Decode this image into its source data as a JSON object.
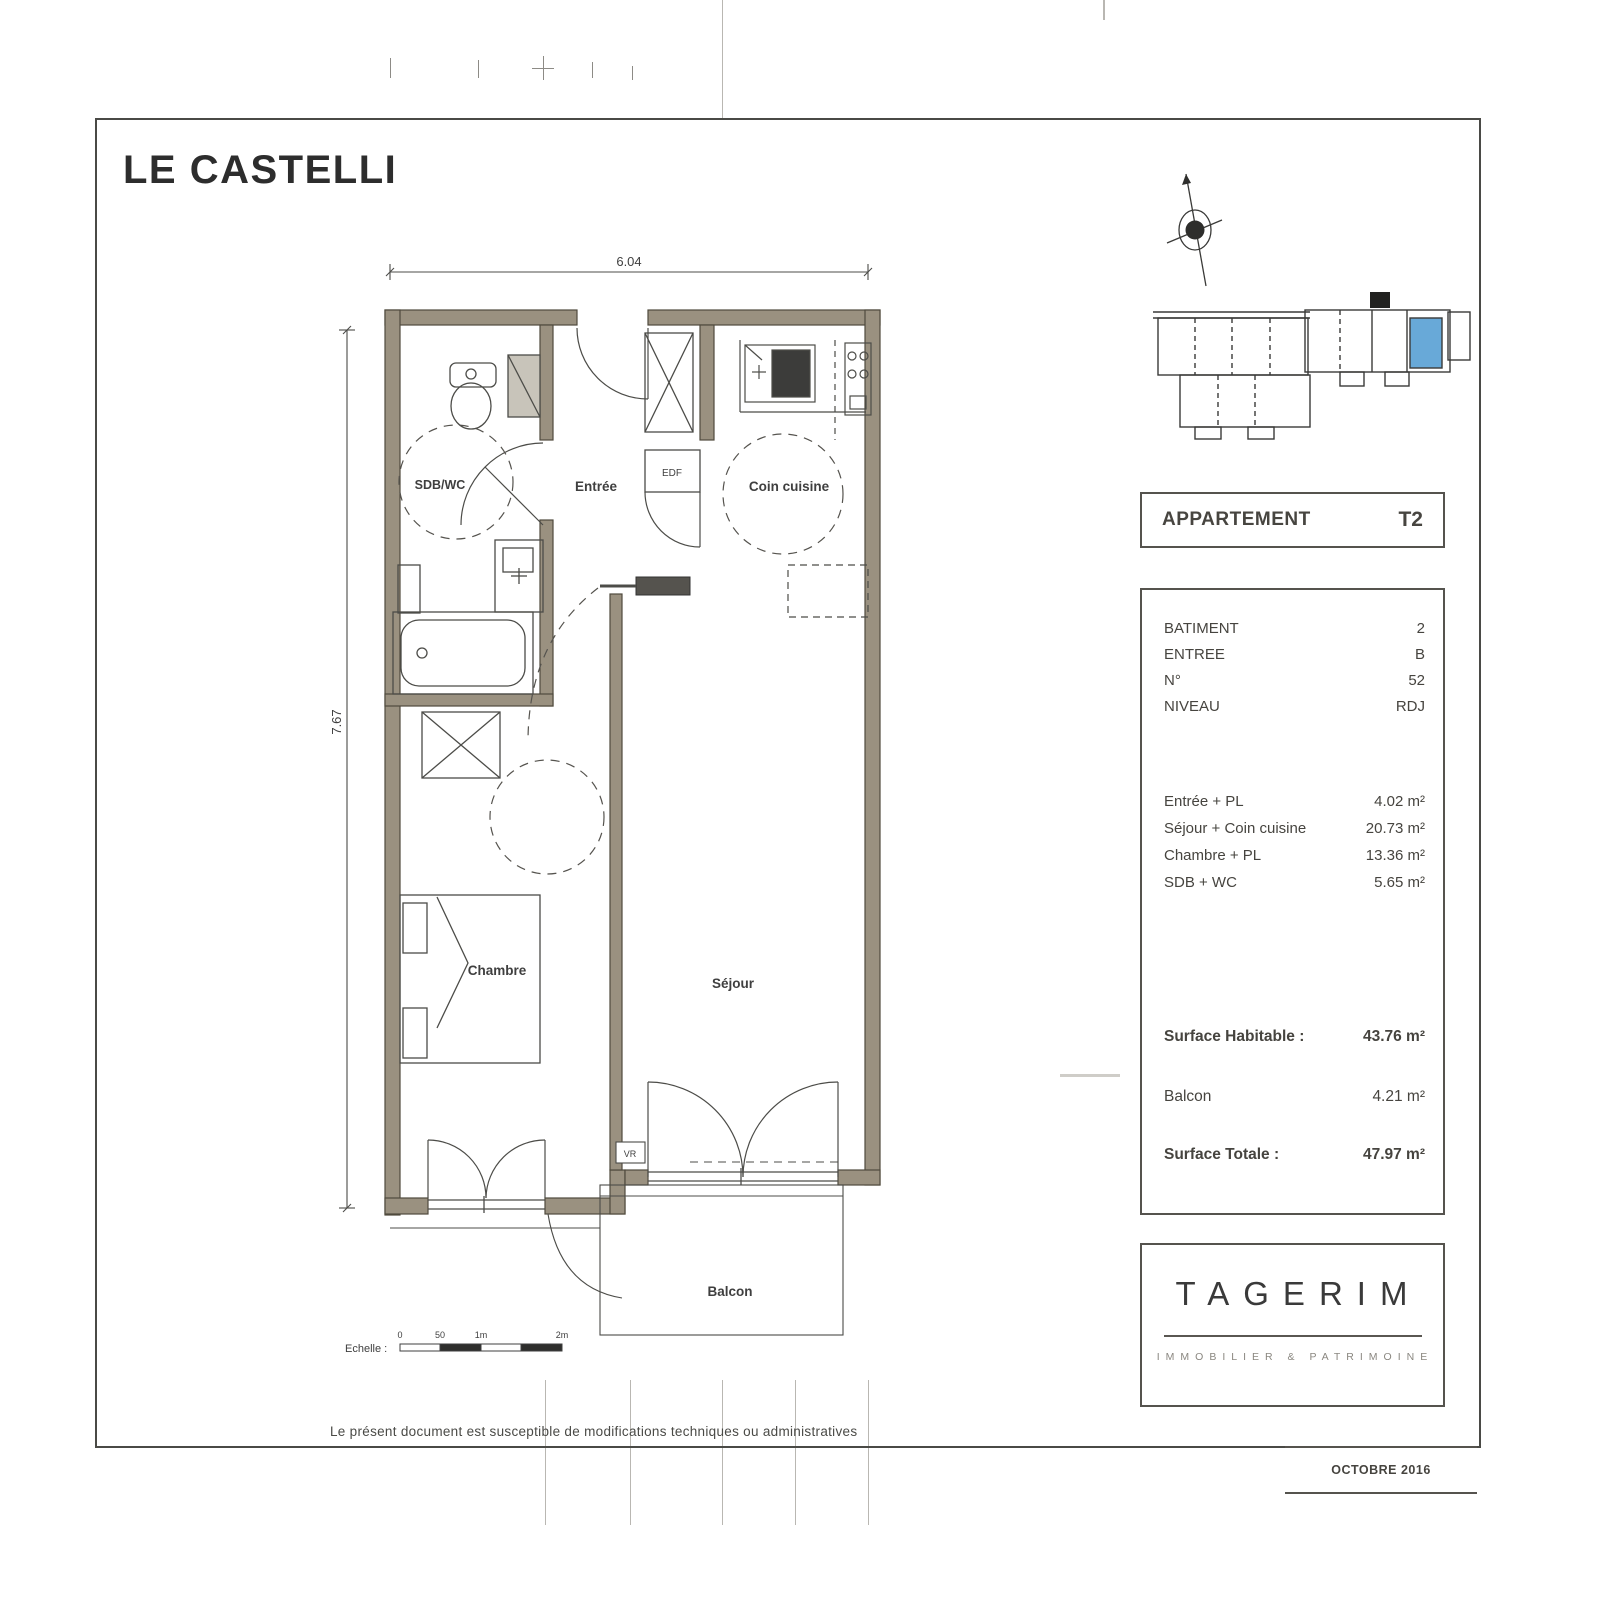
{
  "page": {
    "title": "LE CASTELLI",
    "footer_note": "Le présent document est susceptible de modifications techniques ou administratives",
    "date": "OCTOBRE 2016"
  },
  "plan": {
    "dim_width": "6.04",
    "dim_height": "7.67",
    "scale_label": "Echelle :",
    "scale_ticks": [
      "0",
      "50",
      "1m",
      "2m"
    ],
    "rooms": {
      "sdb": "SDB/WC",
      "entree": "Entrée",
      "cuisine": "Coin cuisine",
      "chambre": "Chambre",
      "sejour": "Séjour",
      "balcon": "Balcon",
      "edf": "EDF",
      "vr": "VR"
    }
  },
  "panel": {
    "apartment_label": "APPARTEMENT",
    "apartment_type": "T2",
    "info": [
      {
        "label": "BATIMENT",
        "value": "2"
      },
      {
        "label": "ENTREE",
        "value": "B"
      },
      {
        "label": "N°",
        "value": "52"
      },
      {
        "label": "NIVEAU",
        "value": "RDJ"
      }
    ],
    "areas": [
      {
        "label": "Entrée + PL",
        "value": "4.02 m²"
      },
      {
        "label": "Séjour + Coin cuisine",
        "value": "20.73 m²"
      },
      {
        "label": "Chambre + PL",
        "value": "13.36 m²"
      },
      {
        "label": "SDB + WC",
        "value": "5.65 m²"
      }
    ],
    "totals": [
      {
        "label": "Surface Habitable :",
        "value": "43.76 m²"
      },
      {
        "label": "Balcon",
        "value": "4.21 m²"
      },
      {
        "label": "Surface Totale :",
        "value": "47.97 m²"
      }
    ]
  },
  "brand": {
    "name": "TAGERIM",
    "tagline": "IMMOBILIER & PATRIMOINE"
  },
  "colors": {
    "wall": "#9a9180",
    "highlight_unit": "#68a9d8",
    "ink": "#3f3f3f"
  }
}
